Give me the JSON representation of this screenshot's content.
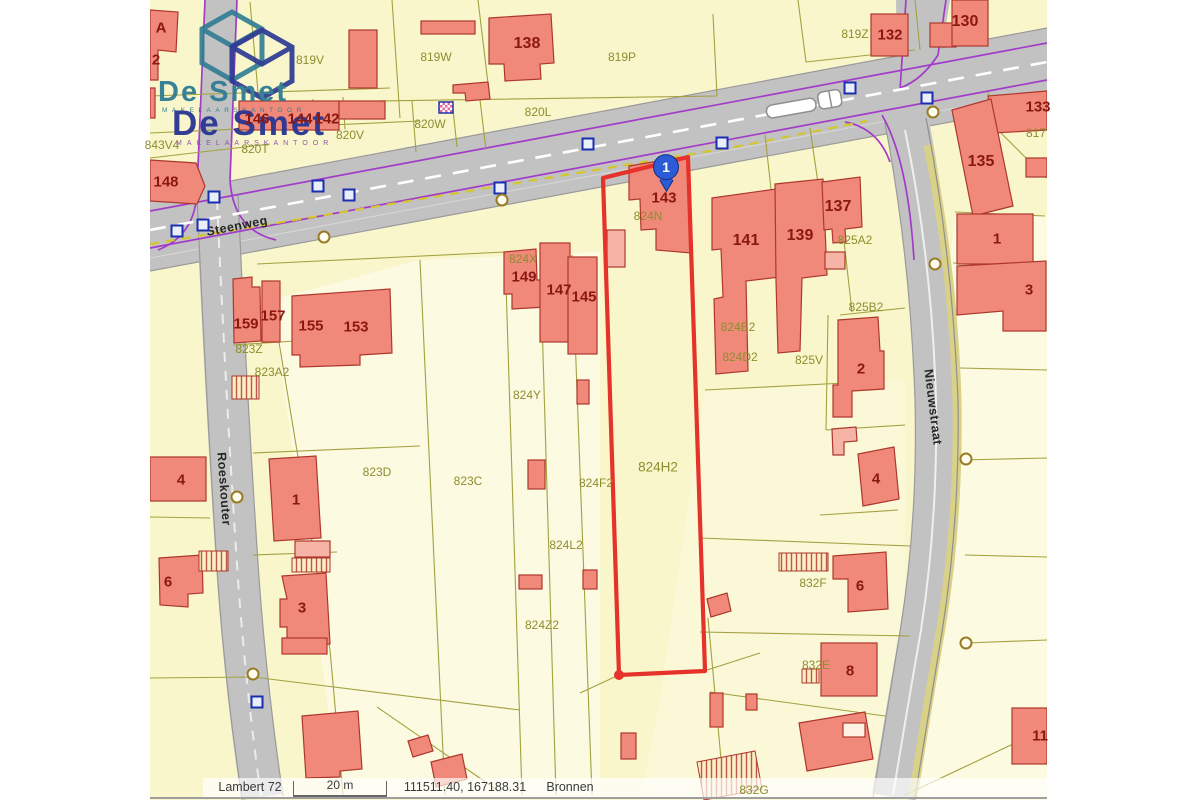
{
  "palette": {
    "parcel_fill": "#FAF6CC",
    "parcel_fill_light": "#FCFAE1",
    "parcel_line": "#A3A13F",
    "building_fill": "#F0897A",
    "building_light": "#F5B4A6",
    "building_stroke": "#AE372D",
    "road_fill": "#C2C2C2",
    "sidewalk": "#CFCFCF",
    "road_edge": "#9A9A9A",
    "verge": "#D9D188",
    "utility_purple": "#A23CC8",
    "utility_yellow": "#D4C62E",
    "selected_red": "#E5322A",
    "vertex_blue": "#1A2FB0",
    "pin_blue": "#2B5BD7",
    "house_text": "#8A1710",
    "parcel_text": "#8E8D2E",
    "logo_teal": "#2F7C93",
    "logo_blue": "#283593",
    "logo_purple": "#8C4DA8"
  },
  "logo": {
    "name1": "De Smet",
    "sub1": "MAKELAARSKANTOOR",
    "name2": "De Smet",
    "sub2": "MAKELAARSKANTOOR"
  },
  "status_bar": {
    "crs": "Lambert 72",
    "scale_label": "20 m",
    "coordinates": "111511.40, 167188.31",
    "sources_label": "Bronnen"
  },
  "map": {
    "pin": {
      "label": "1"
    },
    "selected_parcel": "824H2",
    "house_numbers": [
      {
        "t": "A",
        "x": 161,
        "y": 28
      },
      {
        "t": "2",
        "x": 156,
        "y": 60
      },
      {
        "t": "146",
        "x": 257,
        "y": 119
      },
      {
        "t": "144",
        "x": 300,
        "y": 119
      },
      {
        "t": "142",
        "x": 327,
        "y": 119
      },
      {
        "t": "148",
        "x": 166,
        "y": 182
      },
      {
        "t": "138",
        "x": 527,
        "y": 44,
        "s": 16
      },
      {
        "t": "132",
        "x": 890,
        "y": 35
      },
      {
        "t": "130",
        "x": 965,
        "y": 22,
        "s": 16
      },
      {
        "t": "133",
        "x": 1038,
        "y": 107
      },
      {
        "t": "135",
        "x": 981,
        "y": 162,
        "s": 16
      },
      {
        "t": "1",
        "x": 997,
        "y": 239
      },
      {
        "t": "3",
        "x": 1029,
        "y": 290
      },
      {
        "t": "159",
        "x": 246,
        "y": 324
      },
      {
        "t": "157",
        "x": 273,
        "y": 316
      },
      {
        "t": "155",
        "x": 311,
        "y": 326
      },
      {
        "t": "153",
        "x": 356,
        "y": 327
      },
      {
        "t": "149",
        "x": 524,
        "y": 277
      },
      {
        "t": "147",
        "x": 559,
        "y": 290
      },
      {
        "t": "145",
        "x": 584,
        "y": 297
      },
      {
        "t": "143",
        "x": 664,
        "y": 198
      },
      {
        "t": "141",
        "x": 746,
        "y": 241,
        "s": 16
      },
      {
        "t": "139",
        "x": 800,
        "y": 236,
        "s": 16
      },
      {
        "t": "137",
        "x": 838,
        "y": 207,
        "s": 16
      },
      {
        "t": "2",
        "x": 861,
        "y": 369
      },
      {
        "t": "4",
        "x": 876,
        "y": 479
      },
      {
        "t": "4",
        "x": 181,
        "y": 480
      },
      {
        "t": "1",
        "x": 296,
        "y": 500
      },
      {
        "t": "6",
        "x": 168,
        "y": 582
      },
      {
        "t": "3",
        "x": 302,
        "y": 608
      },
      {
        "t": "6",
        "x": 860,
        "y": 586
      },
      {
        "t": "8",
        "x": 850,
        "y": 671
      },
      {
        "t": "11",
        "x": 1040,
        "y": 736
      }
    ],
    "parcel_codes": [
      {
        "t": "843V4",
        "x": 162,
        "y": 145
      },
      {
        "t": "819V",
        "x": 310,
        "y": 60
      },
      {
        "t": "819W",
        "x": 436,
        "y": 57
      },
      {
        "t": "819P",
        "x": 622,
        "y": 57
      },
      {
        "t": "819Z",
        "x": 855,
        "y": 34
      },
      {
        "t": "820L",
        "x": 538,
        "y": 112
      },
      {
        "t": "820W",
        "x": 430,
        "y": 124
      },
      {
        "t": "820V",
        "x": 350,
        "y": 135
      },
      {
        "t": "820T",
        "x": 255,
        "y": 149
      },
      {
        "t": "817",
        "x": 1036,
        "y": 133
      },
      {
        "t": "823Z",
        "x": 249,
        "y": 349
      },
      {
        "t": "823A2",
        "x": 272,
        "y": 372
      },
      {
        "t": "823D",
        "x": 377,
        "y": 472
      },
      {
        "t": "823C",
        "x": 468,
        "y": 481
      },
      {
        "t": "824X",
        "x": 523,
        "y": 259
      },
      {
        "t": "824N",
        "x": 648,
        "y": 216
      },
      {
        "t": "824Y",
        "x": 527,
        "y": 395
      },
      {
        "t": "824F2",
        "x": 596,
        "y": 483
      },
      {
        "t": "824L2",
        "x": 566,
        "y": 545
      },
      {
        "t": "824H2",
        "x": 658,
        "y": 467,
        "s": 13.5
      },
      {
        "t": "824Z2",
        "x": 542,
        "y": 625
      },
      {
        "t": "824E2",
        "x": 738,
        "y": 327
      },
      {
        "t": "824D2",
        "x": 740,
        "y": 357
      },
      {
        "t": "825A2",
        "x": 855,
        "y": 240
      },
      {
        "t": "825B2",
        "x": 866,
        "y": 307
      },
      {
        "t": "825V",
        "x": 809,
        "y": 360
      },
      {
        "t": "832F",
        "x": 813,
        "y": 583
      },
      {
        "t": "832E",
        "x": 816,
        "y": 665
      },
      {
        "t": "832G",
        "x": 754,
        "y": 790
      }
    ],
    "streets": [
      {
        "t": "Steenweg",
        "x": 237,
        "y": 226,
        "r": -11
      },
      {
        "t": "Roeskouter",
        "x": 224,
        "y": 489,
        "r": 86
      },
      {
        "t": "Nieuwstraat",
        "x": 933,
        "y": 407,
        "r": 83
      }
    ],
    "blue_squares": [
      [
        177,
        231
      ],
      [
        203,
        225
      ],
      [
        214,
        197
      ],
      [
        318,
        186
      ],
      [
        349,
        195
      ],
      [
        500,
        188
      ],
      [
        588,
        144
      ],
      [
        722,
        143
      ],
      [
        850,
        88
      ],
      [
        927,
        98
      ],
      [
        257,
        702
      ]
    ],
    "rings": [
      [
        324,
        237
      ],
      [
        502,
        200
      ],
      [
        933,
        112
      ],
      [
        935,
        264
      ],
      [
        966,
        459
      ],
      [
        966,
        643
      ],
      [
        253,
        674
      ],
      [
        237,
        497
      ]
    ]
  }
}
